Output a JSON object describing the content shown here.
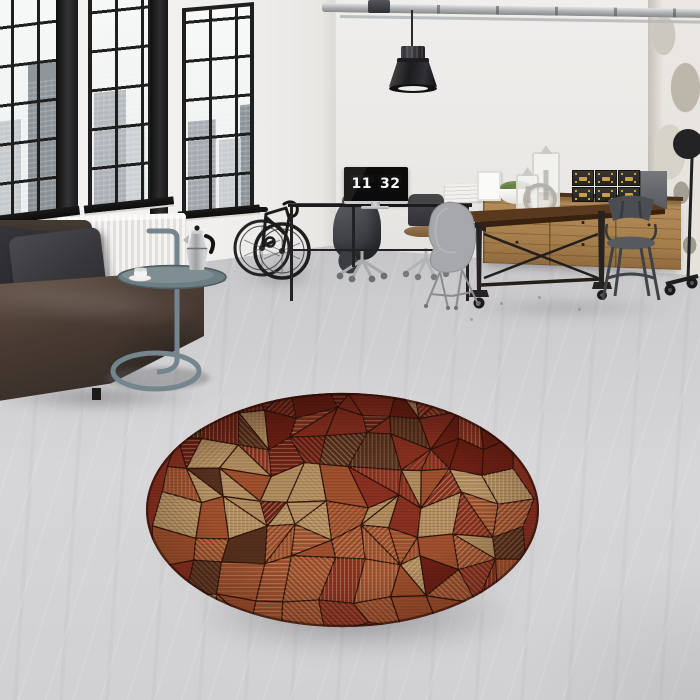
{
  "meta": {
    "scene": "industrial-loft-living-room-photo"
  },
  "clock": {
    "hours": "11",
    "minutes": "32"
  },
  "palette": {
    "frame": "#1f1f1f",
    "latch": "#c9a23a"
  },
  "rug": {
    "shape": "round",
    "grid": {
      "cols": 11,
      "rows": 8
    },
    "hatch_angles": [
      0,
      45,
      90,
      135
    ],
    "colors": {
      "dark_red": "#6d2014",
      "red": "#8a3120",
      "rust": "#a0512e",
      "tan": "#b28e60",
      "cream": "#e2cb9a",
      "brown": "#55301d",
      "outline": "#2e130a"
    }
  },
  "objects": [
    "industrial-windows",
    "city-view",
    "radiator",
    "leather-sofa",
    "throw-pillows",
    "side-table",
    "moka-pot",
    "coffee-cup",
    "bicycle",
    "desk",
    "monitor-flip-clock",
    "office-chairs",
    "hooded-jacket",
    "pendant-lamp",
    "ceiling-pipes",
    "dining-table",
    "metal-chairs",
    "shell-chair",
    "sideboard",
    "storage-boxes",
    "lanterns",
    "potted-plant",
    "books",
    "floor-lamp",
    "round-mosaic-rug",
    "concrete-floor",
    "distressed-wall"
  ]
}
